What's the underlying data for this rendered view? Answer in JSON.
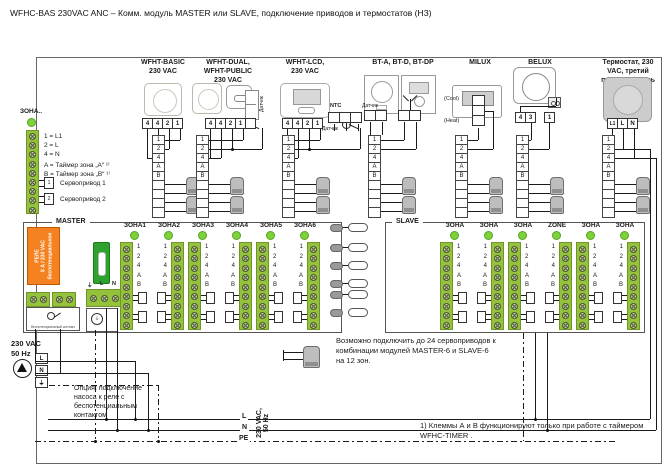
{
  "title": "WFHC-BAS 230VAC ANC – Комм. модуль  MASTER или SLAVE, подключение приводов и термостатов  (НЗ)",
  "strip_labels": [
    "1",
    "2",
    "4",
    "A",
    "B",
    "",
    "",
    "",
    ""
  ],
  "columns": [
    {
      "title": "WFHT-BASIC\n230 VAC",
      "terminals": [
        "4",
        "4",
        "2",
        "1"
      ]
    },
    {
      "title": "WFHT-DUAL,\nWFHT-PUBLIC\n230 VAC",
      "terminals": [
        "4",
        "4",
        "2",
        "1",
        ""
      ],
      "sensor_label": "Датчик"
    },
    {
      "title": "WFHT-LCD,\n230 VAC",
      "terminals": [
        "4",
        "4",
        "2",
        "1"
      ],
      "ntc_label": "NTC",
      "sensor_label": "Датчик"
    },
    {
      "title": "BT-A, BT-D, BT-DP",
      "sensor_label": "Датчик"
    },
    {
      "title": "MILUX",
      "cool": "(Cool)",
      "heat": "(Heat)"
    },
    {
      "title": "BELUX",
      "terminals": [
        "4",
        "3"
      ],
      "terminal_single": "1"
    },
    {
      "title": "Термостат, 230\nVAC, третий\nпроизводитель",
      "terminals": [
        "L1",
        "L",
        "N"
      ]
    }
  ],
  "legend": {
    "zone_label": "ЗОНА..",
    "lines": [
      "1 = L1",
      "2 = L",
      "4 = N",
      "A = Таймер зона „А“ ¹⁾",
      "B = Таймер зона „В“ ¹⁾"
    ],
    "plug1_num": "1",
    "plug2_num": "2",
    "servo1": "Сервопривод 1",
    "servo2": "Сервопривод 2"
  },
  "master": {
    "label": "MASTER",
    "relay_text": "РЕЛЕ\n8 А / 230 VAC\nбеспотенциальное",
    "relay_contact_label": "беспотенциальный контакт",
    "power_labels": [
      "⏚",
      "L",
      "N"
    ],
    "zones": [
      "ЗОНА1",
      "ЗОНА2",
      "ЗОНА3",
      "ЗОНА4",
      "ЗОНА5",
      "ЗОНА6"
    ]
  },
  "slave": {
    "label": "SLAVE",
    "zones": [
      "ЗОНА",
      "ЗОНА",
      "ЗОНА",
      "ZONE",
      "ЗОНА",
      "ЗОНА"
    ]
  },
  "bottom": {
    "supply": "230 VAC\n50 Hz",
    "pump_terminals": [
      "L",
      "N",
      "⏚"
    ],
    "option_text": "Опция: подключение\nнасоса к реле с\nбеспотенциальным\nконтактом",
    "servo_note": "Возможно подключить до 24 сервоприводов к\nкомбинации модулей MASTER-6 и SLAVE-6\nна 12 зон.",
    "bus_labels": [
      "L",
      "N",
      "PE"
    ],
    "bus_voltage": "230 VAC,\n50 Hz",
    "footnote": "1) Клеммы А и В функционируют только при работе с таймером\n      WFHC-TIMER ."
  },
  "colors": {
    "strip_green": "#95c23d",
    "indicator_green": "#7fd13b",
    "relay_orange": "#f58220",
    "fuse_green": "#2fa12f"
  }
}
